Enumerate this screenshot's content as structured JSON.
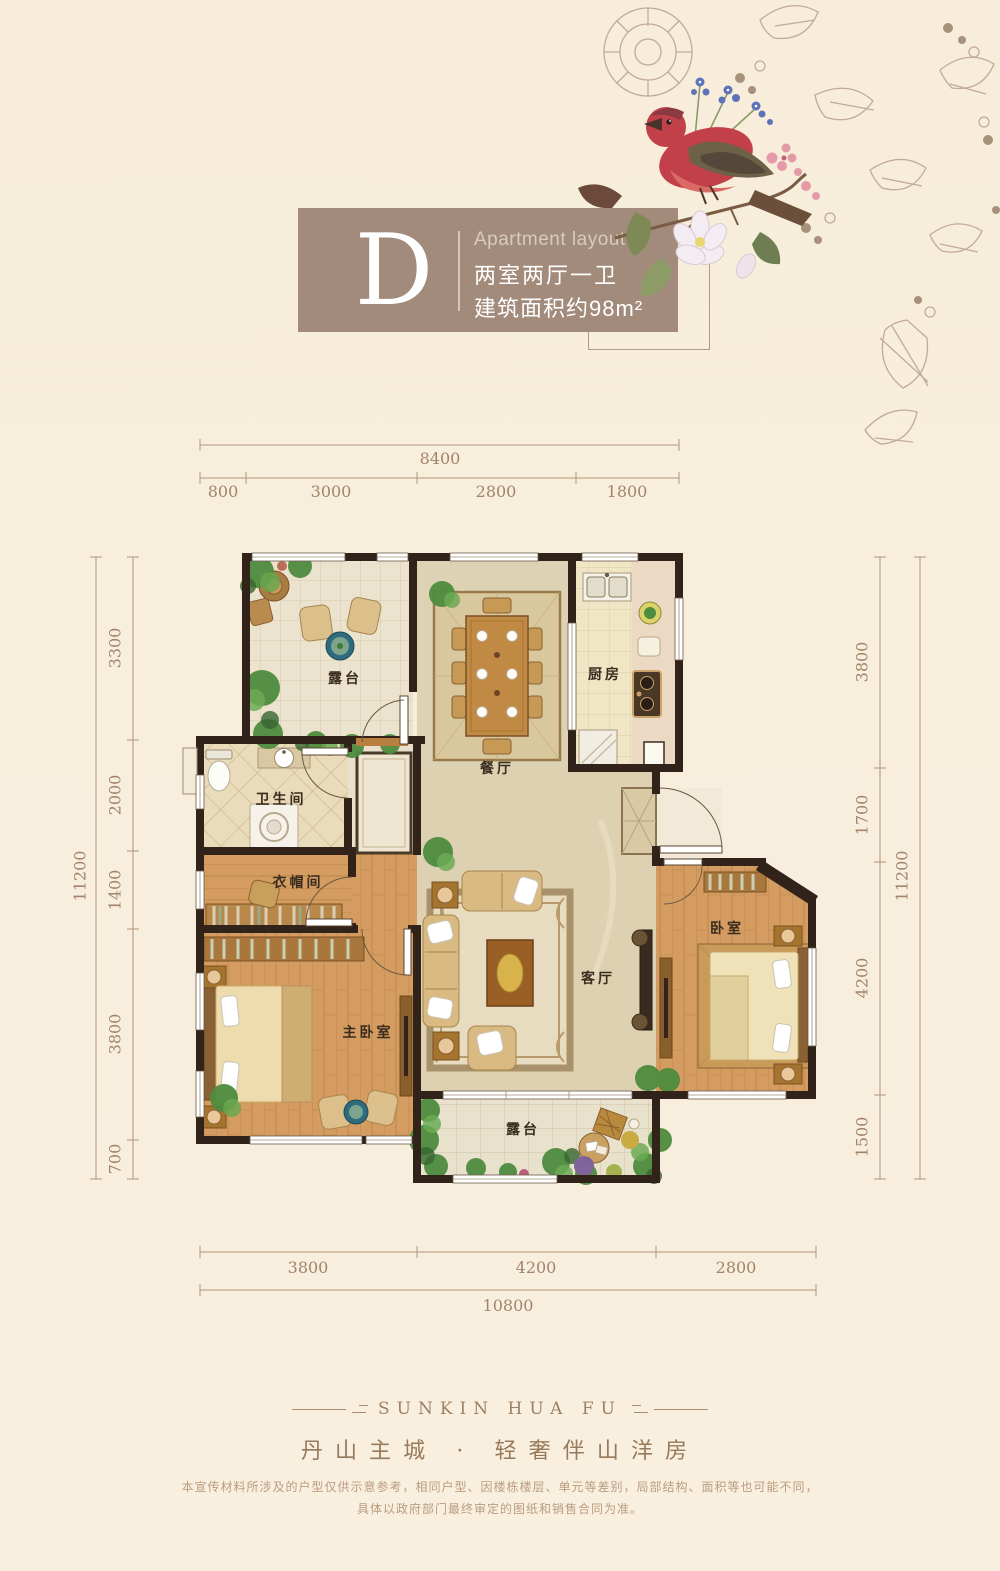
{
  "colors": {
    "background": "#f8eedd",
    "title_box": "#a28b7b",
    "wall": "#31221a",
    "dimension_line": "#b49579",
    "dimension_text": "#a2846a",
    "room_label_text": "#3a2c1e",
    "wood_floor": "#d49c60",
    "tile_floor": "#ece3cf",
    "marble_floor": "#ded2b4",
    "footer_text": "#97795c"
  },
  "header": {
    "letter": "D",
    "category": "Apartment layout",
    "spec": "两室两厅一卫",
    "area": "建筑面积约98m²"
  },
  "plan": {
    "rooms": [
      {
        "id": "terrace-top",
        "label": "露台"
      },
      {
        "id": "dining",
        "label": "餐厅"
      },
      {
        "id": "kitchen",
        "label": "厨房"
      },
      {
        "id": "bathroom",
        "label": "卫生间"
      },
      {
        "id": "cloakroom",
        "label": "衣帽间"
      },
      {
        "id": "master-bedroom",
        "label": "主卧室"
      },
      {
        "id": "living",
        "label": "客厅"
      },
      {
        "id": "bedroom",
        "label": "卧室"
      },
      {
        "id": "terrace-bottom",
        "label": "露台"
      }
    ]
  },
  "dims": {
    "top": {
      "total": "8400",
      "segments": [
        "800",
        "3000",
        "2800",
        "1800"
      ]
    },
    "left": {
      "total": "11200",
      "segments": [
        "3300",
        "2000",
        "1400",
        "3800",
        "700"
      ]
    },
    "right": {
      "total": "11200",
      "segments": [
        "3800",
        "1700",
        "4200",
        "1500"
      ]
    },
    "bottom": {
      "total": "10800",
      "segments": [
        "3800",
        "4200",
        "2800"
      ]
    }
  },
  "footer": {
    "brand": "SUNKIN HUA FU",
    "slogan": "丹山主城 · 轻奢伴山洋房",
    "disclaimer_line1": "本宣传材料所涉及的户型仅供示意参考，相同户型、因楼栋楼层、单元等差别，局部结构、面积等也可能不同，",
    "disclaimer_line2": "具体以政府部门最终审定的图纸和销售合同为准。"
  }
}
